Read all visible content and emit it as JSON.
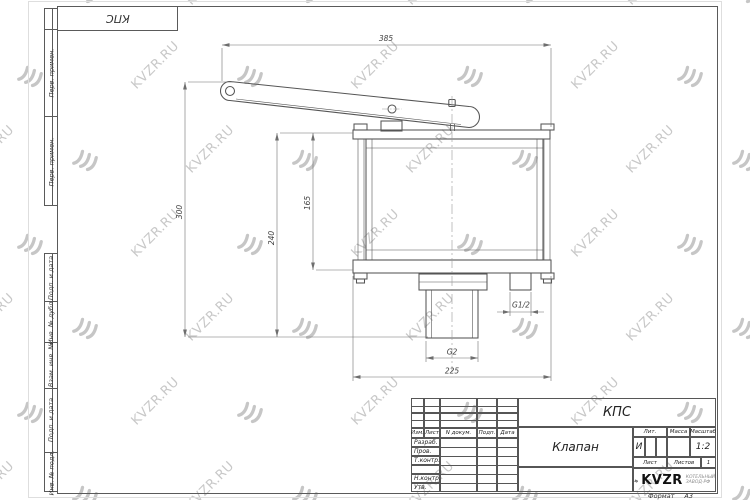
{
  "watermark": {
    "text": "KVZR.RU"
  },
  "sheet": {
    "stamp_top_left": "КПС",
    "format_label": "Формат",
    "format_value": "А3",
    "margin_labels_top": [
      "Перв. примен.",
      "Перв. примен."
    ],
    "margin_labels_bottom": [
      "Подп. и дата",
      "Инв. № дубл.",
      "Взам. инв. №",
      "Подп. и дата",
      "Инв. № подл."
    ]
  },
  "title_block": {
    "designation": "КПС",
    "name": "Клапан",
    "header_cols": [
      "Изм.",
      "Лист",
      "N докум.",
      "Подп.",
      "Дата"
    ],
    "rows": [
      "Разраб.",
      "Пров.",
      "Т.контр.",
      "",
      "Н.контр.",
      "Утв."
    ],
    "lit_label": "Лит.",
    "lit_value": "И",
    "massa_label": "Масса",
    "masshtab_label": "Масштаб",
    "masshtab_value": "1:2",
    "list_label": "Лист",
    "listov_label": "Листов",
    "listov_value": "1",
    "logo_text": "KVZR",
    "logo_sub_line1": "КОТЕЛЬНЫЙ",
    "logo_sub_line2": "ЗАВОД-РФ"
  },
  "drawing": {
    "dims": {
      "lever_length": "385",
      "height_total": "300",
      "height_to_outlet_end": "240",
      "body_height": "165",
      "outlet_thread": "G2",
      "flange_width": "225",
      "drain_thread": "G1/2"
    }
  }
}
